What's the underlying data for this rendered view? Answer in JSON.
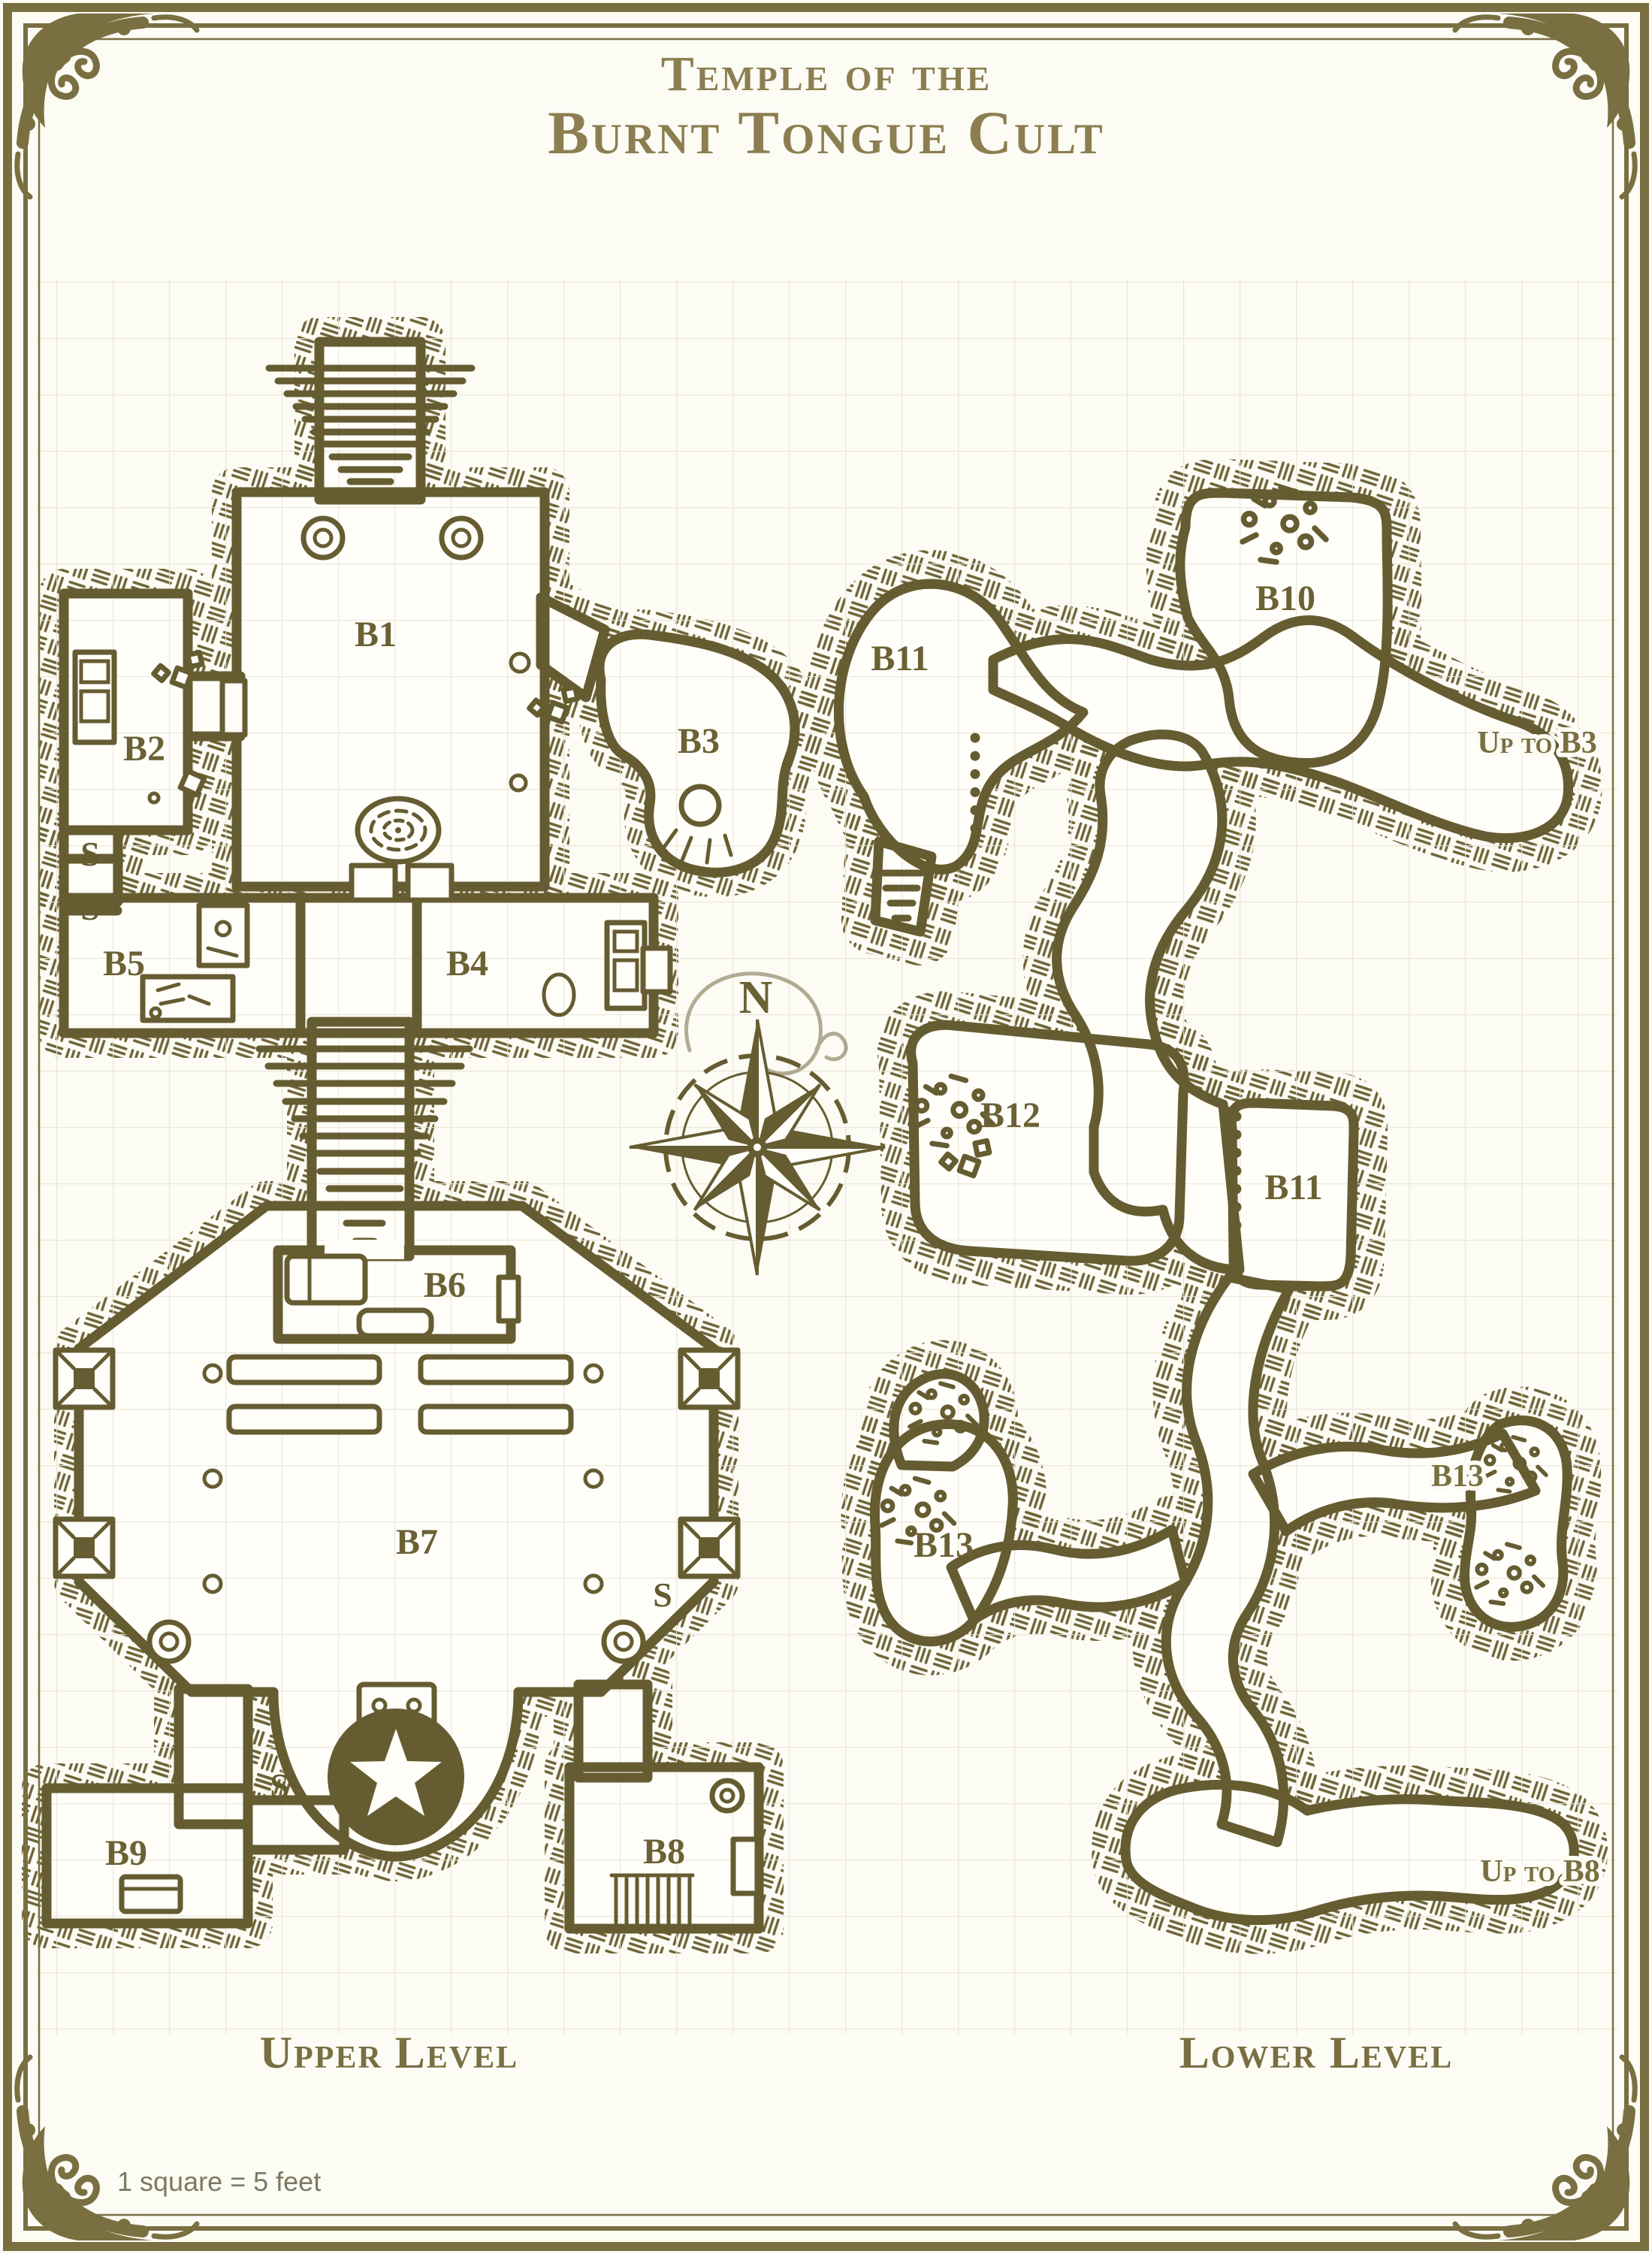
{
  "title": {
    "line1": "Temple of the",
    "line2": "Burnt Tongue Cult"
  },
  "compass": {
    "north_label": "N"
  },
  "levels": {
    "upper": {
      "caption": "Upper Level",
      "rooms": [
        {
          "label": "B1"
        },
        {
          "label": "B2"
        },
        {
          "label": "B3"
        },
        {
          "label": "B4"
        },
        {
          "label": "B5"
        },
        {
          "label": "B6"
        },
        {
          "label": "B7"
        },
        {
          "label": "B8"
        },
        {
          "label": "B9"
        }
      ],
      "secret_marks": [
        "S",
        "S",
        "S",
        "S"
      ]
    },
    "lower": {
      "caption": "Lower Level",
      "rooms": [
        {
          "label": "B11"
        },
        {
          "label": "B10"
        },
        {
          "label": "B12"
        },
        {
          "label": "B11"
        },
        {
          "label": "B13"
        },
        {
          "label": "B13"
        }
      ],
      "annotations": [
        {
          "text": "Up to B3"
        },
        {
          "text": "Up to B8"
        }
      ]
    }
  },
  "footer": {
    "scale_note": "1 square = 5 feet"
  },
  "colors": {
    "ink": "#665c31",
    "label": "#6b6134",
    "title": "#8c7e50",
    "border": "#7a6f41",
    "paper": "#fcfbf4",
    "floor": "#fffef9",
    "grid": "#e7e4d6",
    "muted_text": "#7b7b61"
  },
  "icons": {
    "compass_rose": "eight-point-star",
    "star_dais": "star-in-disc",
    "spiral_well": "concentric-rings",
    "stairs": "tapering-steps",
    "portcullis": "dotted-bars",
    "rubble": "debris-cluster"
  }
}
